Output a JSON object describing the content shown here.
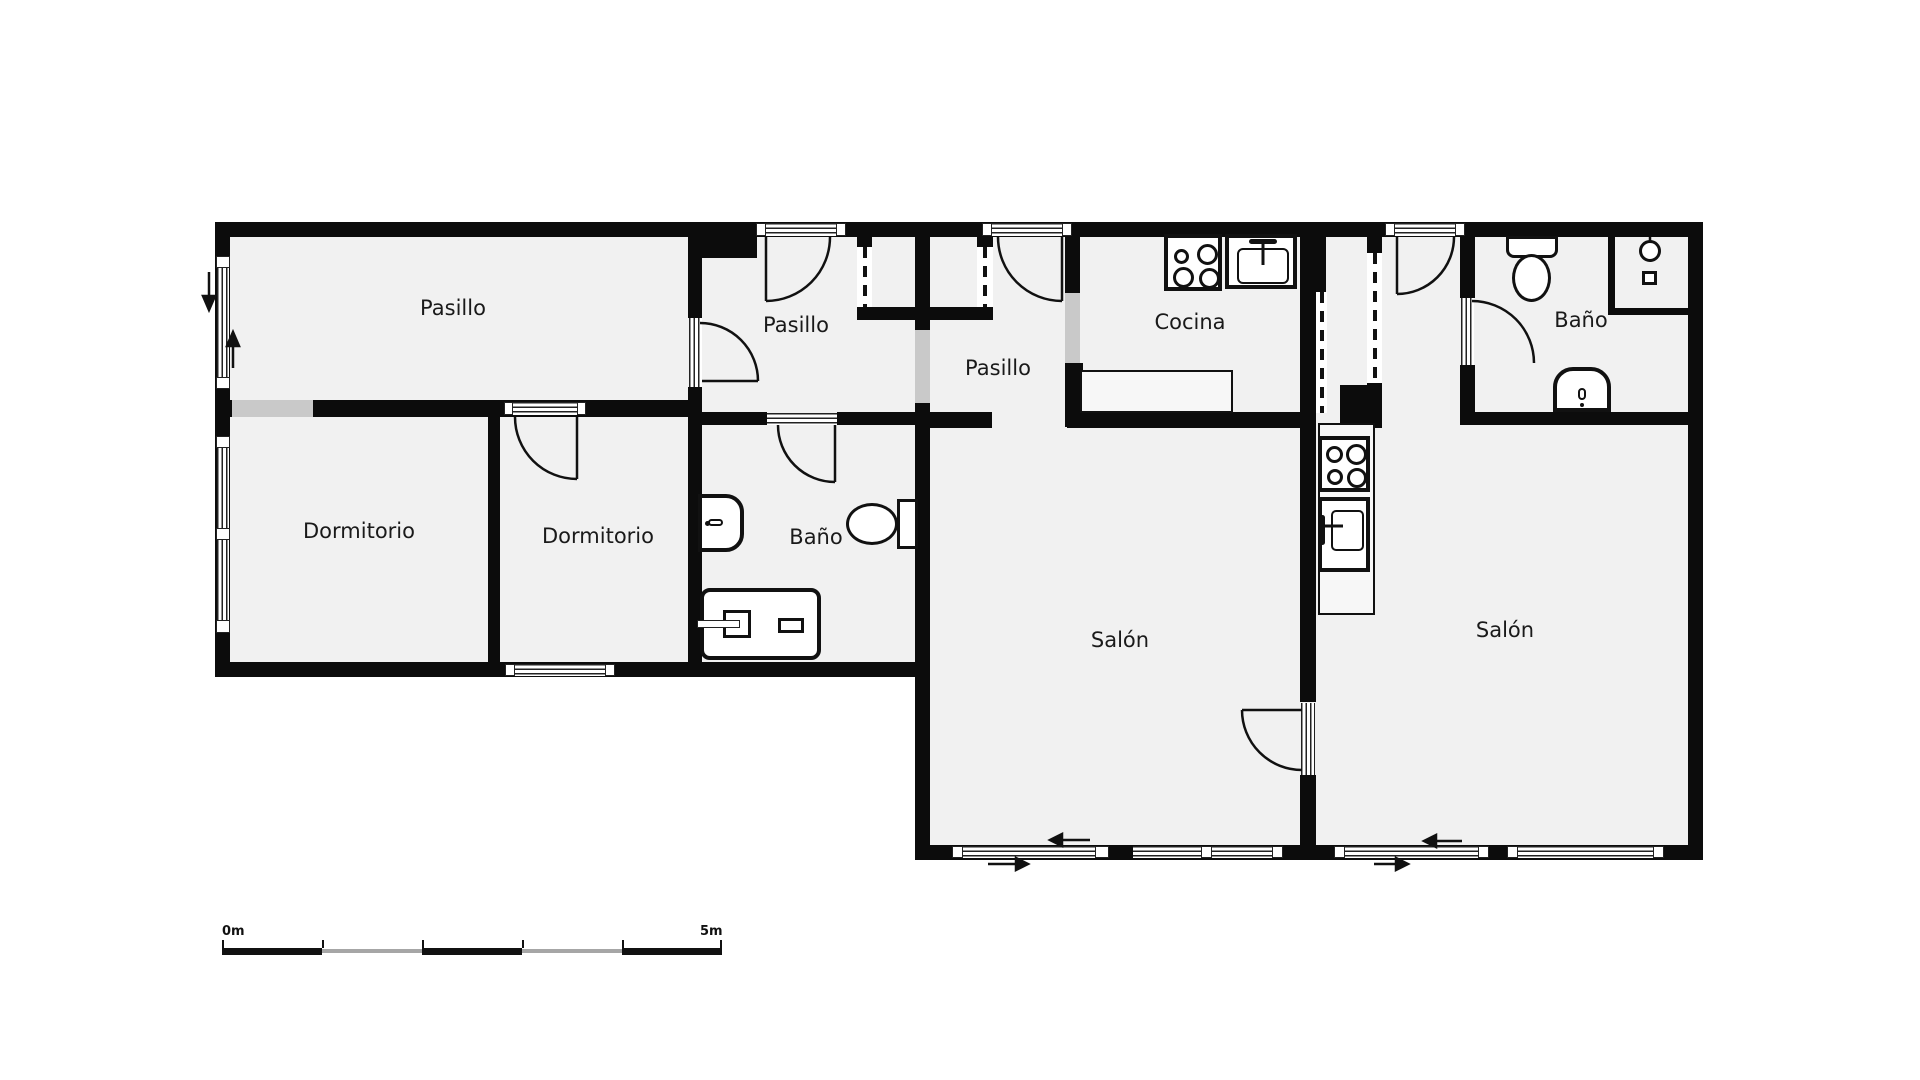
{
  "floorplan": {
    "rooms": [
      {
        "id": "pasillo-main",
        "label": "Pasillo"
      },
      {
        "id": "pasillo-mid",
        "label": "Pasillo"
      },
      {
        "id": "pasillo-right",
        "label": "Pasillo"
      },
      {
        "id": "cocina",
        "label": "Cocina"
      },
      {
        "id": "bano-right",
        "label": "Baño"
      },
      {
        "id": "dormitorio-1",
        "label": "Dormitorio"
      },
      {
        "id": "dormitorio-2",
        "label": "Dormitorio"
      },
      {
        "id": "bano-mid",
        "label": "Baño"
      },
      {
        "id": "salon-left",
        "label": "Salón"
      },
      {
        "id": "salon-right",
        "label": "Salón"
      }
    ],
    "scale_bar": {
      "start_label": "0m",
      "end_label": "5m"
    },
    "colors": {
      "wall": "#0c0c0c",
      "floor": "#f1f1f1",
      "opening": "#c9c9c9",
      "background": "#ffffff"
    }
  }
}
